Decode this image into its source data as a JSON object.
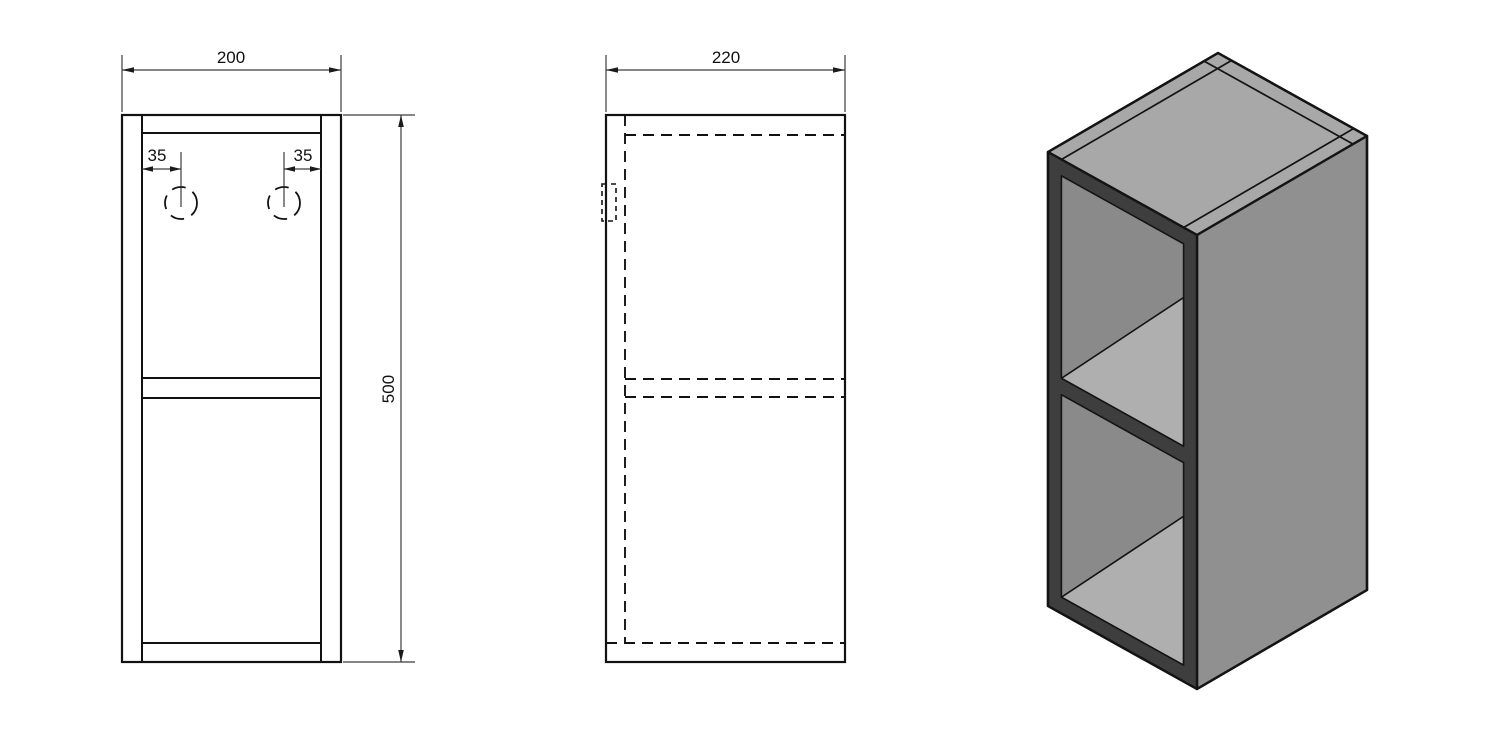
{
  "views": {
    "front": {
      "width_dim": "200",
      "height_dim": "500",
      "hole_offset_left": "35",
      "hole_offset_right": "35"
    },
    "side": {
      "depth_dim": "220"
    },
    "isometric": {
      "colors": {
        "top_face": "#a8a8a8",
        "right_face": "#909090",
        "interior_left_face": "#8a8a8a",
        "shelf_top": "#afafaf",
        "frame_front": "#3e3e3e",
        "outline": "#141414"
      }
    }
  }
}
